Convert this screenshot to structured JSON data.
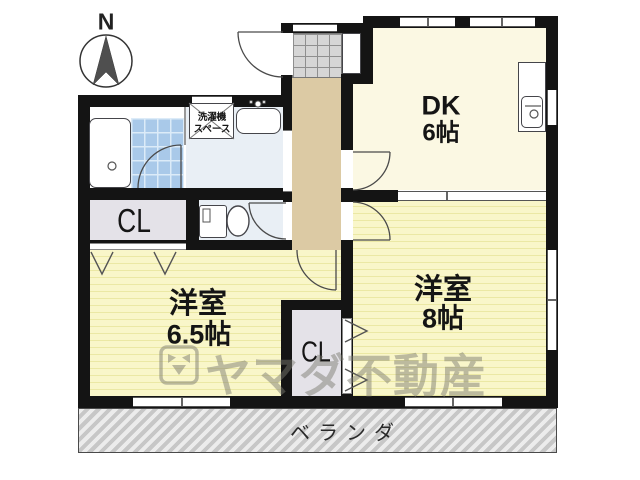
{
  "compass": {
    "label": "N"
  },
  "rooms": {
    "dk": {
      "name": "DK",
      "size": "6帖"
    },
    "west8": {
      "name": "洋室",
      "size": "8帖"
    },
    "west65": {
      "name": "洋室",
      "size": "6.5帖"
    }
  },
  "closets": {
    "left": "CL",
    "center": "CL"
  },
  "laundry": {
    "line1": "洗濯機",
    "line2": "スペース"
  },
  "veranda": {
    "label": "ベランダ"
  },
  "watermark": {
    "text": "ヤマダ不動産"
  },
  "colors": {
    "wall": "#141414",
    "tatami_floor": "#f9f6c9",
    "dk_floor": "#fbf8e3",
    "hall_floor": "#dccaa4",
    "wet_floor": "#e9eff5",
    "bath_tile": "#a9c9e9",
    "closet_fill": "#e4e2e8",
    "veranda_gray": "#d2d2d2",
    "watermark_gray": "#7b7a70"
  }
}
